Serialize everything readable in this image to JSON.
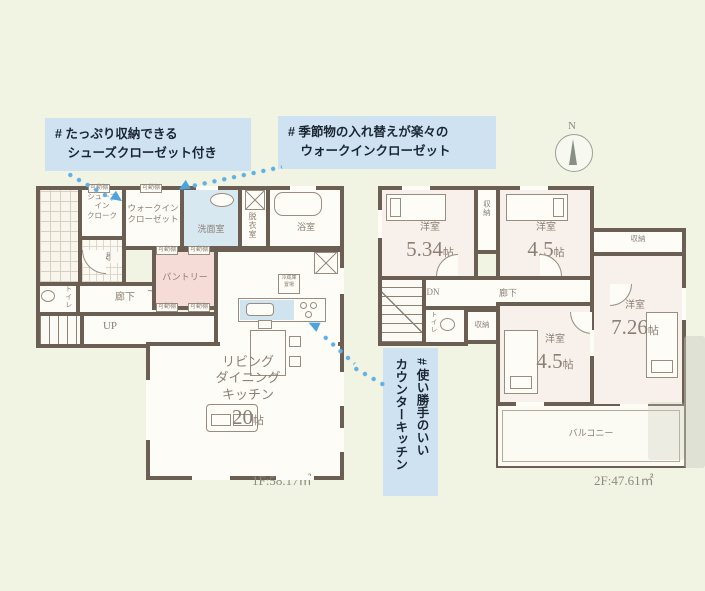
{
  "annotations": {
    "shoes": {
      "text": "# たっぷり収納できる\n　シューズクローゼット付き"
    },
    "wic": {
      "text": "# 季節物の入れ替えが楽々の\n　ウォークインクローゼット"
    },
    "kitchen": {
      "text": "# 使い勝手のいい\nカウンターキッチン"
    }
  },
  "compass": {
    "north": "N"
  },
  "colors": {
    "background": "#f1f3e3",
    "wall": "#6b5e53",
    "annotation_bg": "#cfe2f2",
    "arrow_blue": "#5fb0e6",
    "pantry_pink": "#f6dcd6",
    "washroom_blue": "#d7e8f1"
  },
  "floor1": {
    "area_label": "1F:58.17㎡",
    "rooms": {
      "shoes_cloak": "シューズ\nイン\nクローク",
      "wic": "ウォークイン\nクローゼット",
      "washroom": "洗面室",
      "dressing": "脱衣室",
      "bath": "浴室",
      "entrance": "玄関",
      "pantry": "パントリー",
      "toilet": "トイレ",
      "hall": "廊下",
      "stairs": "UP",
      "ldk": "リビング\nダイニング\nキッチン",
      "ldk_size": "20",
      "jo": "帖",
      "shelf": "可動棚",
      "fridge": "冷蔵庫\n置場"
    }
  },
  "floor2": {
    "area_label": "2F:47.61㎡",
    "rooms": {
      "bedroom": "洋室",
      "bed1_size": "5.34",
      "bed2_size": "4.5",
      "bed3_size": "4.5",
      "bed4_size": "7.26",
      "jo": "帖",
      "storage": "収納",
      "hall": "廊下",
      "stairs": "DN",
      "toilet": "トイレ",
      "balcony": "バルコニー"
    }
  }
}
